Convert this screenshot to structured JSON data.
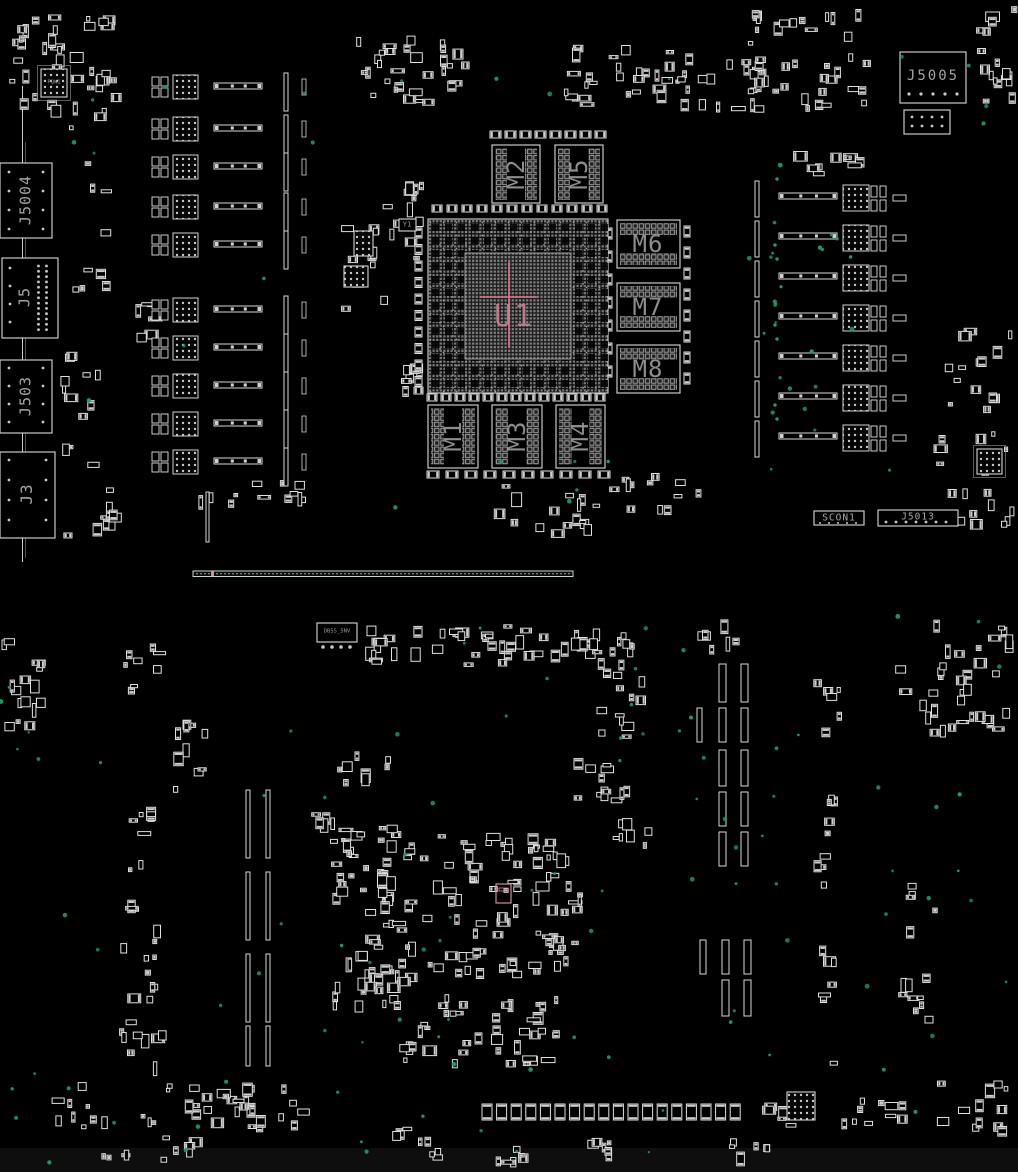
{
  "labels": {
    "u1": "U1",
    "m1": "M1",
    "m2": "M2",
    "m3": "M3",
    "m4": "M4",
    "m5": "M5",
    "m6": "M6",
    "m7": "M7",
    "m8": "M8",
    "j5005": "J5005",
    "j5004": "J5004",
    "j5": "J5",
    "j503": "J503",
    "j3": "J3",
    "scon1": "SCON1",
    "j5013": "J5013",
    "pqw1": "PQW1",
    "y1": "Y1",
    "small_ic": "DB55_5NV"
  },
  "colors": {
    "background": "#000000",
    "bottom_band": "#0e0e0e",
    "outline": "#e0e0e0",
    "pad": "#cfcfcf",
    "board_line": "#cfcfcf",
    "conn_line": "#c4d8cc",
    "pink": "#d9899c",
    "pink_bright": "#e0738b",
    "testpoint": "#16a169"
  },
  "board": {
    "bottom_band": [
      0,
      1148,
      1018,
      24
    ],
    "bga": {
      "outer": [
        428,
        219,
        180,
        174
      ],
      "inner": [
        465,
        253,
        106,
        106
      ],
      "crosshair": {
        "vx": 509,
        "vy1": 262,
        "vy2": 347,
        "hy": 297,
        "hx1": 480,
        "hx2": 537
      }
    },
    "drams": [
      [
        492,
        145,
        48,
        58,
        1
      ],
      [
        555,
        145,
        48,
        58,
        1
      ],
      [
        617,
        220,
        63,
        48,
        0
      ],
      [
        617,
        283,
        63,
        48,
        0
      ],
      [
        617,
        345,
        63,
        48,
        0
      ],
      [
        428,
        405,
        50,
        63,
        1
      ],
      [
        492,
        405,
        50,
        63,
        1
      ],
      [
        556,
        405,
        49,
        63,
        1
      ]
    ],
    "boxes": [
      [
        0,
        163,
        52,
        75
      ],
      [
        2,
        258,
        56,
        80
      ],
      [
        0,
        360,
        52,
        73
      ],
      [
        0,
        452,
        55,
        86
      ],
      [
        900,
        52,
        66,
        51
      ],
      [
        904,
        110,
        46,
        24
      ],
      [
        814,
        511,
        50,
        14
      ],
      [
        878,
        510,
        80,
        16
      ],
      [
        317,
        623,
        40,
        19
      ],
      [
        399,
        219,
        17,
        12
      ]
    ],
    "chips": [
      [
        41,
        69,
        26,
        28
      ],
      [
        354,
        231,
        19,
        25
      ],
      [
        344,
        266,
        24,
        21
      ],
      [
        787,
        1092,
        28,
        28
      ],
      [
        977,
        449,
        25,
        25
      ]
    ],
    "chip_rings": [
      [
        37.5,
        65.5,
        33,
        35
      ],
      [
        973.5,
        445.5,
        32,
        32
      ]
    ],
    "left_rows": {
      "rows": [
        75,
        117,
        155,
        195,
        233,
        298,
        336,
        374,
        412,
        450
      ]
    },
    "right_rows": {
      "rows": [
        185,
        225,
        265,
        305,
        345,
        385,
        425
      ]
    },
    "vbars": [
      [
        246,
        790,
        4,
        68
      ],
      [
        266,
        790,
        4,
        68
      ],
      [
        246,
        872,
        4,
        68
      ],
      [
        266,
        872,
        4,
        68
      ],
      [
        246,
        954,
        4,
        68
      ],
      [
        266,
        954,
        4,
        68
      ],
      [
        246,
        1026,
        4,
        40
      ],
      [
        266,
        1026,
        4,
        40
      ],
      [
        719,
        664,
        7,
        38
      ],
      [
        741,
        664,
        7,
        38
      ],
      [
        697,
        708,
        5,
        34
      ],
      [
        719,
        708,
        7,
        34
      ],
      [
        741,
        708,
        7,
        34
      ],
      [
        719,
        750,
        7,
        36
      ],
      [
        741,
        750,
        7,
        36
      ],
      [
        719,
        792,
        7,
        34
      ],
      [
        741,
        792,
        7,
        34
      ],
      [
        719,
        832,
        7,
        34
      ],
      [
        741,
        832,
        7,
        34
      ],
      [
        700,
        940,
        6,
        34
      ],
      [
        722,
        940,
        7,
        34
      ],
      [
        744,
        940,
        7,
        34
      ],
      [
        722,
        980,
        7,
        36
      ],
      [
        744,
        980,
        7,
        36
      ],
      [
        206,
        492,
        3,
        50
      ]
    ],
    "caprows": [
      {
        "x": 432,
        "y": 205,
        "n": 12,
        "step": 15,
        "w": 10,
        "h": 7
      },
      {
        "x": 427,
        "y": 394,
        "n": 13,
        "step": 14,
        "w": 10,
        "h": 7
      },
      {
        "x": 415,
        "y": 228,
        "n": 10,
        "step": 16.5,
        "w": 7,
        "h": 10,
        "col": 1
      },
      {
        "x": 482,
        "y": 1104,
        "n": 18,
        "step": 14.6,
        "w": 10,
        "h": 16
      },
      {
        "x": 427,
        "y": 471,
        "n": 10,
        "step": 19,
        "w": 12,
        "h": 7
      },
      {
        "x": 490,
        "y": 131,
        "n": 8,
        "step": 15,
        "w": 11,
        "h": 7
      },
      {
        "x": 684,
        "y": 226,
        "n": 8,
        "step": 21,
        "w": 6,
        "h": 11,
        "col": 1
      },
      {
        "x": 606,
        "y": 228,
        "n": 7,
        "step": 23,
        "w": 6,
        "h": 11,
        "col": 1
      }
    ],
    "dotgrids": [
      {
        "x": 38.5,
        "y": 266,
        "n": 13,
        "step": 5.3,
        "v": 1
      },
      {
        "x": 46.5,
        "y": 266,
        "n": 13,
        "step": 5.3,
        "v": 1
      },
      {
        "x": 10,
        "y": 268,
        "n": 4,
        "step": 18,
        "v": 1
      },
      {
        "x": 9,
        "y": 172,
        "n": 4,
        "step": 19,
        "v": 1
      },
      {
        "x": 43,
        "y": 172,
        "n": 4,
        "step": 19,
        "v": 1
      },
      {
        "x": 9,
        "y": 368,
        "n": 4,
        "step": 18,
        "v": 1
      },
      {
        "x": 43,
        "y": 368,
        "n": 4,
        "step": 18,
        "v": 1
      },
      {
        "x": 9,
        "y": 460,
        "n": 4,
        "step": 20,
        "v": 1
      },
      {
        "x": 46,
        "y": 460,
        "n": 4,
        "step": 20,
        "v": 1
      },
      {
        "x": 909,
        "y": 94,
        "n": 5,
        "step": 12,
        "v": 0,
        "r": 1.6
      },
      {
        "x": 912,
        "y": 117,
        "n": 4,
        "step": 10,
        "v": 0
      },
      {
        "x": 912,
        "y": 126,
        "n": 4,
        "step": 10,
        "v": 0
      },
      {
        "x": 886,
        "y": 522,
        "n": 7,
        "step": 10,
        "v": 0
      },
      {
        "x": 820,
        "y": 523,
        "n": 5,
        "step": 9,
        "v": 0,
        "r": 1
      },
      {
        "x": 323,
        "y": 647,
        "n": 4,
        "step": 9,
        "v": 0,
        "r": 1.8
      }
    ],
    "clusters": [
      [
        8,
        14,
        120,
        116,
        40
      ],
      [
        345,
        36,
        125,
        70,
        30
      ],
      [
        560,
        42,
        150,
        70,
        34
      ],
      [
        700,
        58,
        60,
        60,
        10
      ],
      [
        745,
        8,
        130,
        105,
        40
      ],
      [
        973,
        2,
        45,
        120,
        16
      ],
      [
        60,
        148,
        55,
        390,
        26
      ],
      [
        120,
        300,
        42,
        42,
        6
      ],
      [
        340,
        182,
        88,
        130,
        20
      ],
      [
        393,
        330,
        38,
        70,
        8
      ],
      [
        398,
        178,
        30,
        26,
        5
      ],
      [
        790,
        148,
        80,
        28,
        10
      ],
      [
        938,
        322,
        75,
        105,
        14
      ],
      [
        930,
        425,
        85,
        55,
        10
      ],
      [
        940,
        488,
        75,
        55,
        10
      ],
      [
        608,
        468,
        95,
        50,
        12
      ],
      [
        480,
        480,
        130,
        58,
        16
      ],
      [
        250,
        480,
        60,
        45,
        8
      ],
      [
        85,
        505,
        40,
        28,
        5
      ],
      [
        195,
        492,
        52,
        18,
        4
      ],
      [
        0,
        628,
        46,
        108,
        16
      ],
      [
        360,
        625,
        70,
        40,
        12
      ],
      [
        432,
        622,
        120,
        45,
        22
      ],
      [
        545,
        622,
        100,
        50,
        16
      ],
      [
        600,
        640,
        50,
        65,
        10
      ],
      [
        690,
        618,
        55,
        40,
        6
      ],
      [
        118,
        640,
        50,
        62,
        8
      ],
      [
        160,
        718,
        48,
        75,
        10
      ],
      [
        123,
        795,
        42,
        85,
        8
      ],
      [
        120,
        885,
        46,
        80,
        8
      ],
      [
        122,
        968,
        42,
        58,
        6
      ],
      [
        116,
        1028,
        52,
        55,
        8
      ],
      [
        303,
        806,
        32,
        28,
        5
      ],
      [
        330,
        822,
        88,
        95,
        40
      ],
      [
        332,
        918,
        85,
        95,
        36
      ],
      [
        335,
        742,
        60,
        45,
        8
      ],
      [
        420,
        832,
        165,
        95,
        55
      ],
      [
        420,
        928,
        160,
        55,
        30
      ],
      [
        430,
        990,
        130,
        35,
        14
      ],
      [
        398,
        1022,
        165,
        48,
        26
      ],
      [
        560,
        758,
        75,
        45,
        12
      ],
      [
        608,
        815,
        45,
        45,
        8
      ],
      [
        595,
        700,
        40,
        40,
        6
      ],
      [
        895,
        618,
        120,
        120,
        36
      ],
      [
        898,
        862,
        40,
        210,
        14
      ],
      [
        812,
        668,
        30,
        400,
        22
      ],
      [
        840,
        1092,
        70,
        40,
        10
      ],
      [
        905,
        1078,
        110,
        62,
        12
      ],
      [
        50,
        1082,
        260,
        52,
        40
      ],
      [
        158,
        1136,
        50,
        28,
        6
      ],
      [
        388,
        1124,
        55,
        45,
        8
      ],
      [
        492,
        1142,
        45,
        26,
        6
      ],
      [
        572,
        1136,
        45,
        28,
        6
      ],
      [
        722,
        1138,
        48,
        28,
        6
      ],
      [
        757,
        1098,
        40,
        30,
        6
      ],
      [
        92,
        1140,
        42,
        22,
        4
      ]
    ],
    "pink_parts": [
      [
        496,
        884,
        15,
        19
      ]
    ],
    "long_connector": {
      "rect": [
        193,
        571,
        380,
        5.5
      ],
      "tick": [
        211,
        571.6,
        3,
        4.6
      ]
    },
    "edge_lines": [
      [
        22.5,
        86,
        22.5,
        562,
        1,
        "#cfcfcf"
      ],
      [
        25.5,
        142,
        25.5,
        558,
        0.7,
        "#707070"
      ]
    ],
    "testpoints": [
      [
        60,
        70,
        250,
        400,
        8
      ],
      [
        742,
        150,
        150,
        330,
        16
      ],
      [
        300,
        58,
        400,
        85,
        5
      ],
      [
        900,
        35,
        110,
        100,
        4
      ],
      [
        0,
        600,
        120,
        520,
        12
      ],
      [
        150,
        620,
        560,
        500,
        40
      ],
      [
        720,
        640,
        80,
        420,
        12
      ],
      [
        860,
        600,
        150,
        520,
        16
      ],
      [
        330,
        425,
        380,
        95,
        6
      ],
      [
        20,
        1115,
        880,
        50,
        10
      ],
      [
        615,
        690,
        120,
        120,
        6
      ],
      [
        770,
        165,
        12,
        310,
        10
      ]
    ]
  }
}
